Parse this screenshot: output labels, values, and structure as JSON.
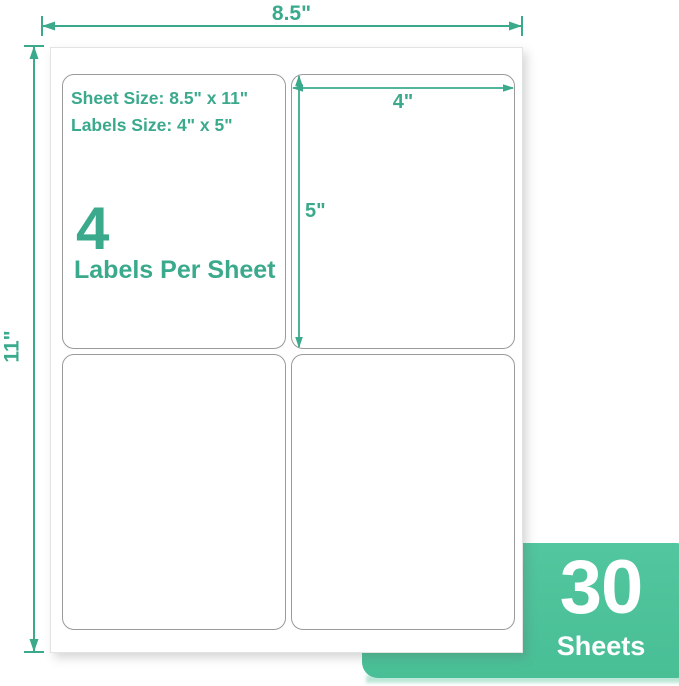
{
  "colors": {
    "accent_teal": "#3aa98c",
    "badge_green": "#52c69e",
    "badge_glow": "#bce7d7",
    "label_border": "#9a9a9a"
  },
  "sheet_dimensions": {
    "width_label": "8.5\"",
    "height_label": "11\""
  },
  "label_dimensions": {
    "width_label": "4\"",
    "height_label": "5\""
  },
  "specs": {
    "sheet_size_line": "Sheet Size: 8.5\" x 11\"",
    "labels_size_line": "Labels Size: 4\" x 5\"",
    "labels_per_sheet_count": "4",
    "labels_per_sheet_caption": "Labels Per Sheet"
  },
  "badge": {
    "count": "30",
    "unit": "Sheets"
  }
}
